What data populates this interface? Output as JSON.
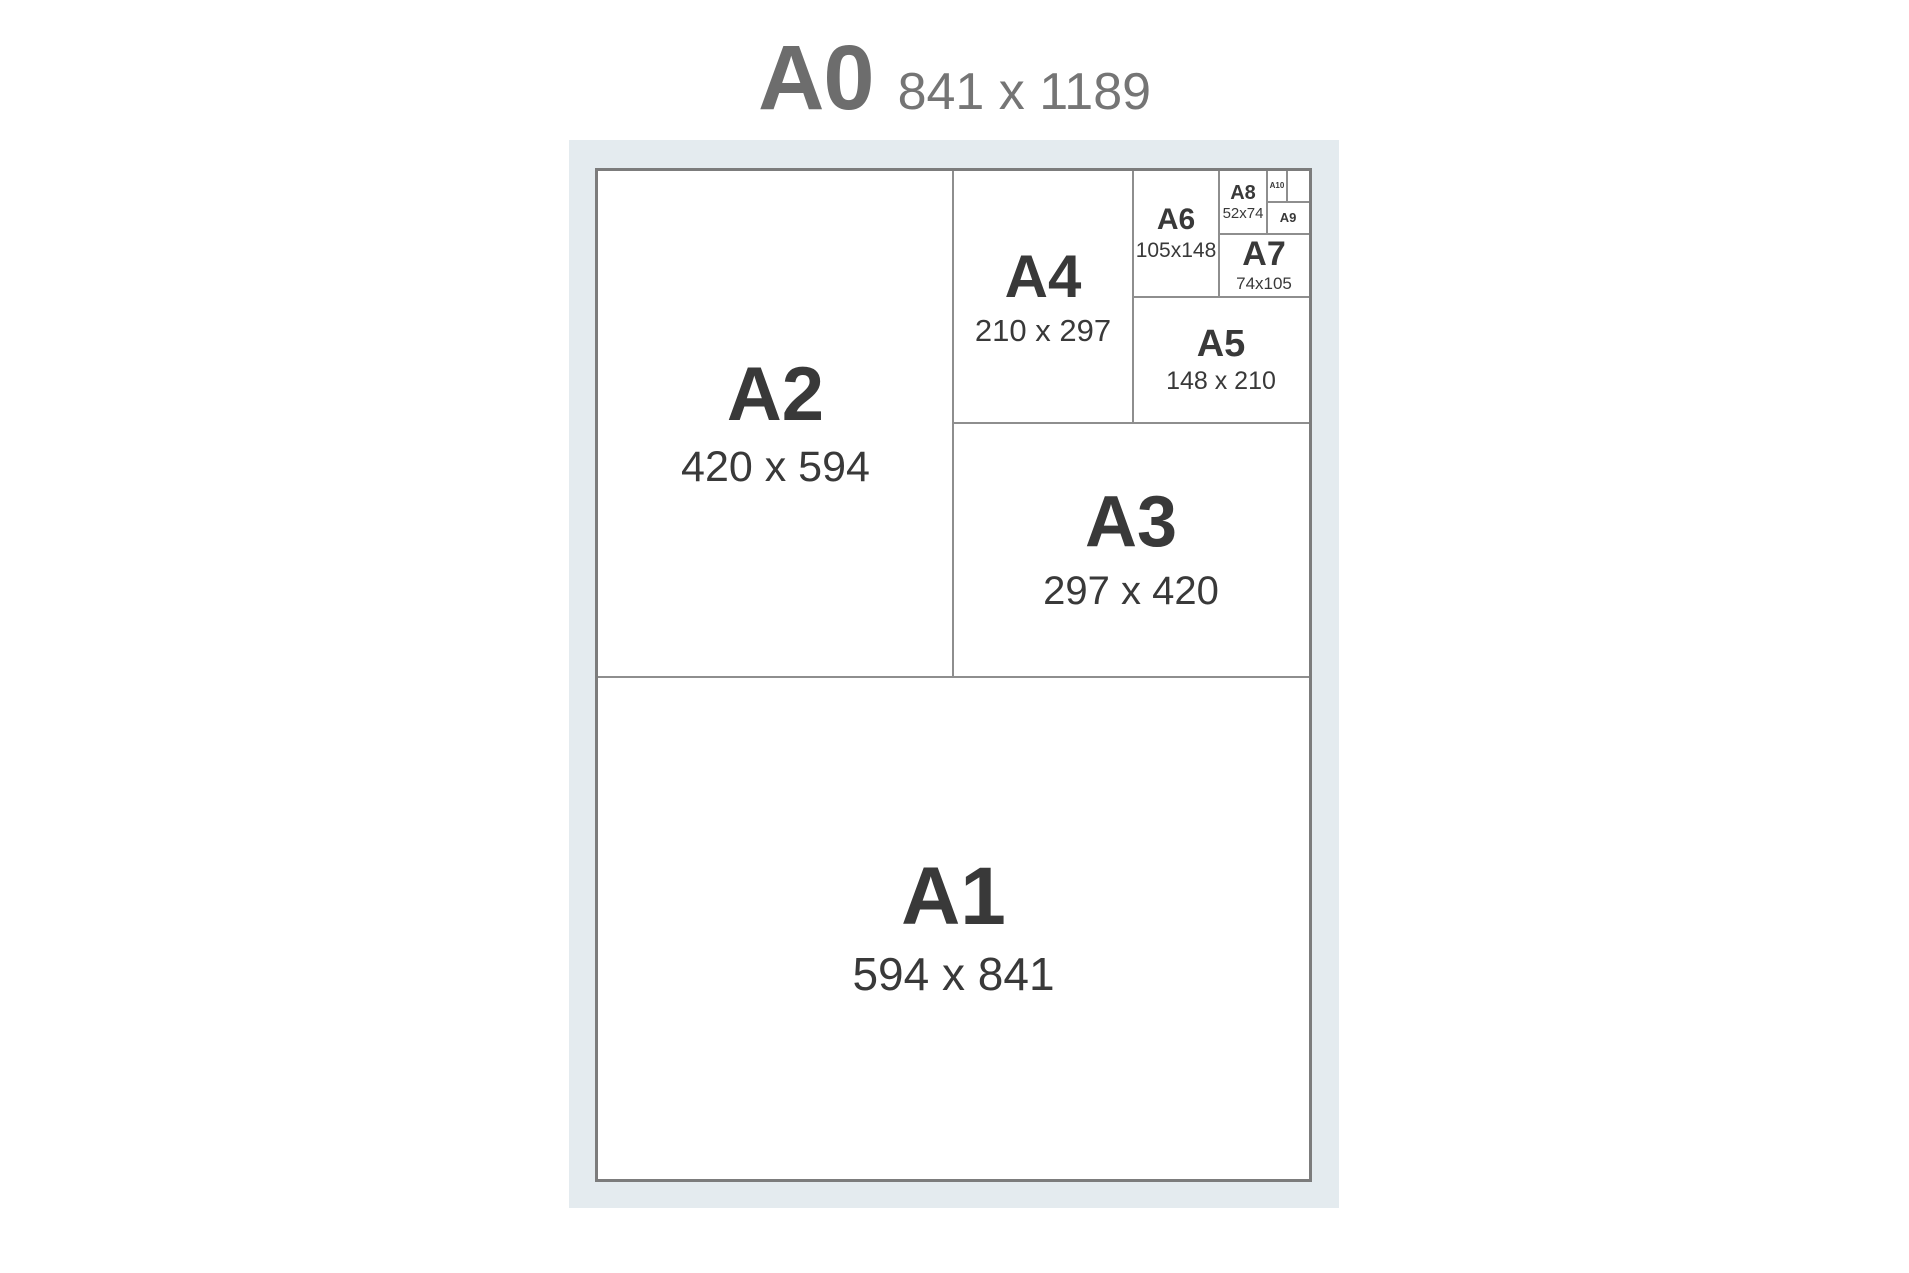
{
  "title": {
    "name": "A0",
    "dims": "841 x 1189"
  },
  "panels": {
    "a1": {
      "name": "A1",
      "dims": "594 x 841"
    },
    "a2": {
      "name": "A2",
      "dims": "420 x 594"
    },
    "a3": {
      "name": "A3",
      "dims": "297 x 420"
    },
    "a4": {
      "name": "A4",
      "dims": "210 x 297"
    },
    "a5": {
      "name": "A5",
      "dims": "148 x 210"
    },
    "a6": {
      "name": "A6",
      "dims": "105x148"
    },
    "a7": {
      "name": "A7",
      "dims": "74x105"
    },
    "a8": {
      "name": "A8",
      "dims": "52x74"
    },
    "a9": {
      "name": "A9"
    },
    "a10": {
      "name": "A10"
    }
  },
  "colors": {
    "page_bg": "#ffffff",
    "mat_bg": "#e4ebef",
    "sheet_bg": "#ffffff",
    "sheet_border": "#7c7c7c",
    "divider": "#8e8e8e",
    "title_text": "#6d6d6d",
    "label_text": "#393939"
  }
}
